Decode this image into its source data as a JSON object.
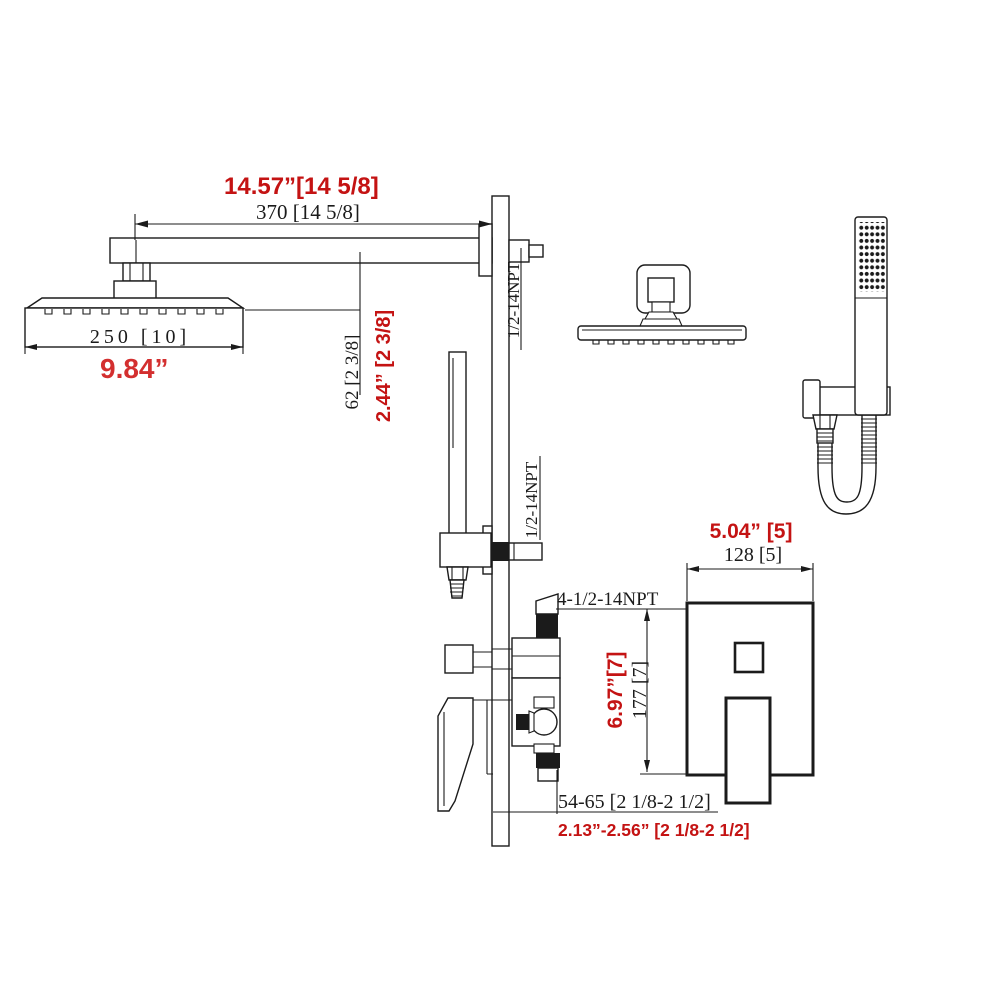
{
  "diagram_title": "shower system installation dimension drawing",
  "colors": {
    "line": "#1b1b1b",
    "red_bold": "#c41313",
    "red_plain": "#d32f2f",
    "background": "#ffffff"
  },
  "dimensions": {
    "arm_length": {
      "metric": "370 [14 5/8]",
      "imperial": "14.57”[14 5/8]"
    },
    "arm_drop": {
      "metric": "62 [2 3/8]",
      "imperial": "2.44” [2 3/8]"
    },
    "head_width": {
      "metric": "250 [10]",
      "imperial": "9.84”"
    },
    "plate_width": {
      "metric": "128  [5]",
      "imperial": "5.04”  [5]"
    },
    "plate_height": {
      "metric": "177  [7]",
      "imperial": "6.97”[7]"
    },
    "valve_depth": {
      "metric": "54-65  [2 1/8-2 1/2]",
      "imperial": "2.13”-2.56” [2 1/8-2 1/2]"
    }
  },
  "thread_labels": {
    "shower_arm": "1/2-14NPT",
    "hand_shower_outlet": "1/2-14NPT",
    "valve_ports": "4-1/2-14NPT"
  }
}
